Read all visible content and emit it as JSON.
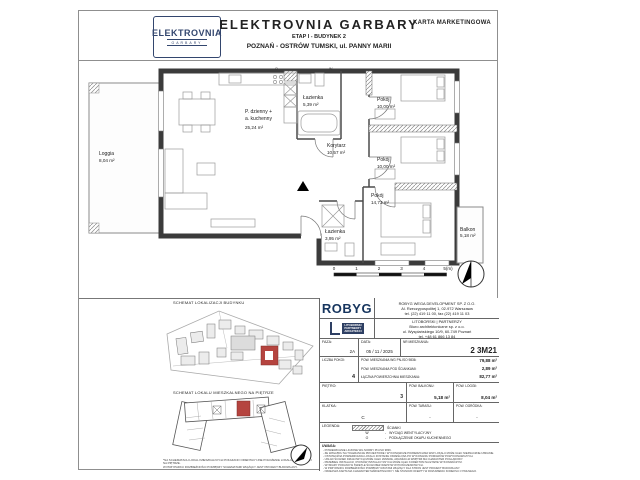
{
  "header": {
    "logo_main": "ELEKTROVNIA",
    "logo_sub": "GARBARY",
    "title": "ELEKTROVNIA GARBARY",
    "subtitle": "ETAP I - BUDYNEK 2",
    "address": "POZNAŃ - OSTRÓW TUMSKI, ul. PANNY MARII",
    "card_type": "KARTA MARKETINGOWA"
  },
  "plan": {
    "rooms": {
      "living": {
        "l1": "P. dzienny +",
        "l2": "a. kuchenny",
        "area": "25,24 m²"
      },
      "bath1": {
        "name": "Łazienka",
        "area": "5,39 m²"
      },
      "corridor": {
        "name": "Korytarz",
        "area": "10,57 m²"
      },
      "room1": {
        "name": "Pokój",
        "area": "10,00 m²"
      },
      "room2": {
        "name": "Pokój",
        "area": "10,00 m²"
      },
      "bedroom": {
        "name": "Pokój",
        "area": "14,73 m²"
      },
      "bath2": {
        "name": "Łazienka",
        "area": "3,95 m²"
      },
      "loggia": {
        "name": "Loggia",
        "area": "8,04 m²"
      },
      "balcony": {
        "name": "Balkon",
        "area": "5,18 m²"
      }
    },
    "markers": {
      "vent": "W",
      "hood": "O"
    },
    "scale_ticks": [
      "0",
      "1",
      "2",
      "3",
      "4",
      "5(m)"
    ]
  },
  "schematics": {
    "location_label": "SCHEMAT LOKALIZACJI BUDYNKU",
    "floor_label": "SCHEMAT LOKALU MIESZKALNEGO NA PIĘTRZE",
    "footnote_1": "*NA SCHEMATACH LOKALI MIESZKALNYCH POKAZANO ORIENTACYJNE POŁOŻENIE LOKALU W BUDYNKU I NA PIĘTRZE.",
    "footnote_2": "W PRZYPADKU ROZBIEŻNOŚCI POMIĘDZY SCHEMATAMI WIĄŻĄCY JEST PROJEKT BUDOWLANY."
  },
  "developer": {
    "brand": "ROBYG",
    "line1": "ROBYG WEGA DEVELOPMENT SP. Z O.O.",
    "line2": "Al. Rzeczypospolitej 1, 02-972 Warszawa",
    "line3": "tel. (22) 419 11 00, fax (22) 419 11 03"
  },
  "architect": {
    "logo_l1": "LITOBORSKI",
    "logo_l2": "PARTNERZY",
    "logo_l3": "ARCHITEKCI",
    "line1": "LITOBORSKI | PARTNERZY",
    "line2": "Biuro architektoniczne sp. z o.o.",
    "line3": "ul. Wyspiańskiego 10/9, 60-749 Poznań",
    "line4": "tel. +48 61 866 13 84"
  },
  "table": {
    "faza_label": "FAZA:",
    "faza_value": "2A",
    "data_label": "DATA:",
    "data_value": "05 / 11 / 2025",
    "nr_label": "NR MIESZKANIA:",
    "nr_value": "2 3M21",
    "liczba_label": "LICZBA POKOI:",
    "liczba_value": "4",
    "pow_iso_label": "POW. MIESZKANIA WG PN-ISO 9836:",
    "pow_iso_value": "79,88 m²",
    "pow_scianki_label": "POW. MIESZKANIA POD ŚCIANKAMI:",
    "pow_scianki_value": "2,89 m²",
    "pow_laczna_label": "ŁĄCZNA POWIERZCHNIA MIESZKANIA:",
    "pow_laczna_value": "82,77 m²",
    "pietro_label": "PIĘTRO:",
    "pietro_value": "3",
    "balkon_label": "POW. BALKONU:",
    "balkon_value": "5,18 m²",
    "loggia_label": "POW. LOGGII:",
    "loggia_value": "8,04 m²",
    "klatka_label": "KLATKA:",
    "klatka_value": "C",
    "taras_label": "POW. TARASU:",
    "taras_value": "-",
    "ogrodek_label": "POW. OGRÓDKA:",
    "ogrodek_value": "-"
  },
  "legend": {
    "title": "LEGENDA:",
    "walls": "ŚCIANKI",
    "w_symbol": "W",
    "w_desc": "WYCIĄG WENTYLACYJNY",
    "o_symbol": "O",
    "o_desc": "PODŁĄCZENIE OKAPU KUCHENNEGO"
  },
  "uwaga": {
    "title": "UWAGA:",
    "lines": [
      "- POWIERZCHNIE LICZONE WG NORMY PN-ISO 9836.",
      "- ZE WZGLĘDU NA TOLERANCJE PROJEKTOWE I WYKONAWCZE POWIERZCHNIA W/W LOKALU MOŻE ULEC NIEZNACZNEJ ZMIANIE.",
      "- OSTATECZNA POWIERZCHNIA LOKALU ZOSTANIE OKREŚLONA PO WYKONANIU POMIARÓW POWYKONAWCZYCH.",
      "- UKŁAD ŚCIANEK DZIAŁOWYCH MOŻE ULEC ZMIANIE, ARANŻACJA WNĘTRZ MA CHARAKTER POGLĄDOWY.",
      "- PRZEBIEG INSTALACJI I PIONÓW INSTALACYJNYCH MOŻE ULEC KOREKTOM NA ETAPIE WYKONAWCZYM.",
      "- WYMIARY PODANO W ŚWIETLE ŚCIAN BEZ WARSTW WYKOŃCZENIOWYCH.",
      "- W PRZYPADKU ROZBIEŻNOŚCI POMIĘDZY RZUTAMI WIĄŻĄCY DLA STRON JEST PROJEKT BUDOWLANY.",
      "- NINIEJSZA KARTA MA CHARAKTER MARKETINGOWY I NIE STANOWI OFERTY W ROZUMIENIU KODEKSU CYWILNEGO."
    ]
  },
  "colors": {
    "navy": "#1d3a6d",
    "red": "#b5443f",
    "wall": "#3b3b3b"
  }
}
